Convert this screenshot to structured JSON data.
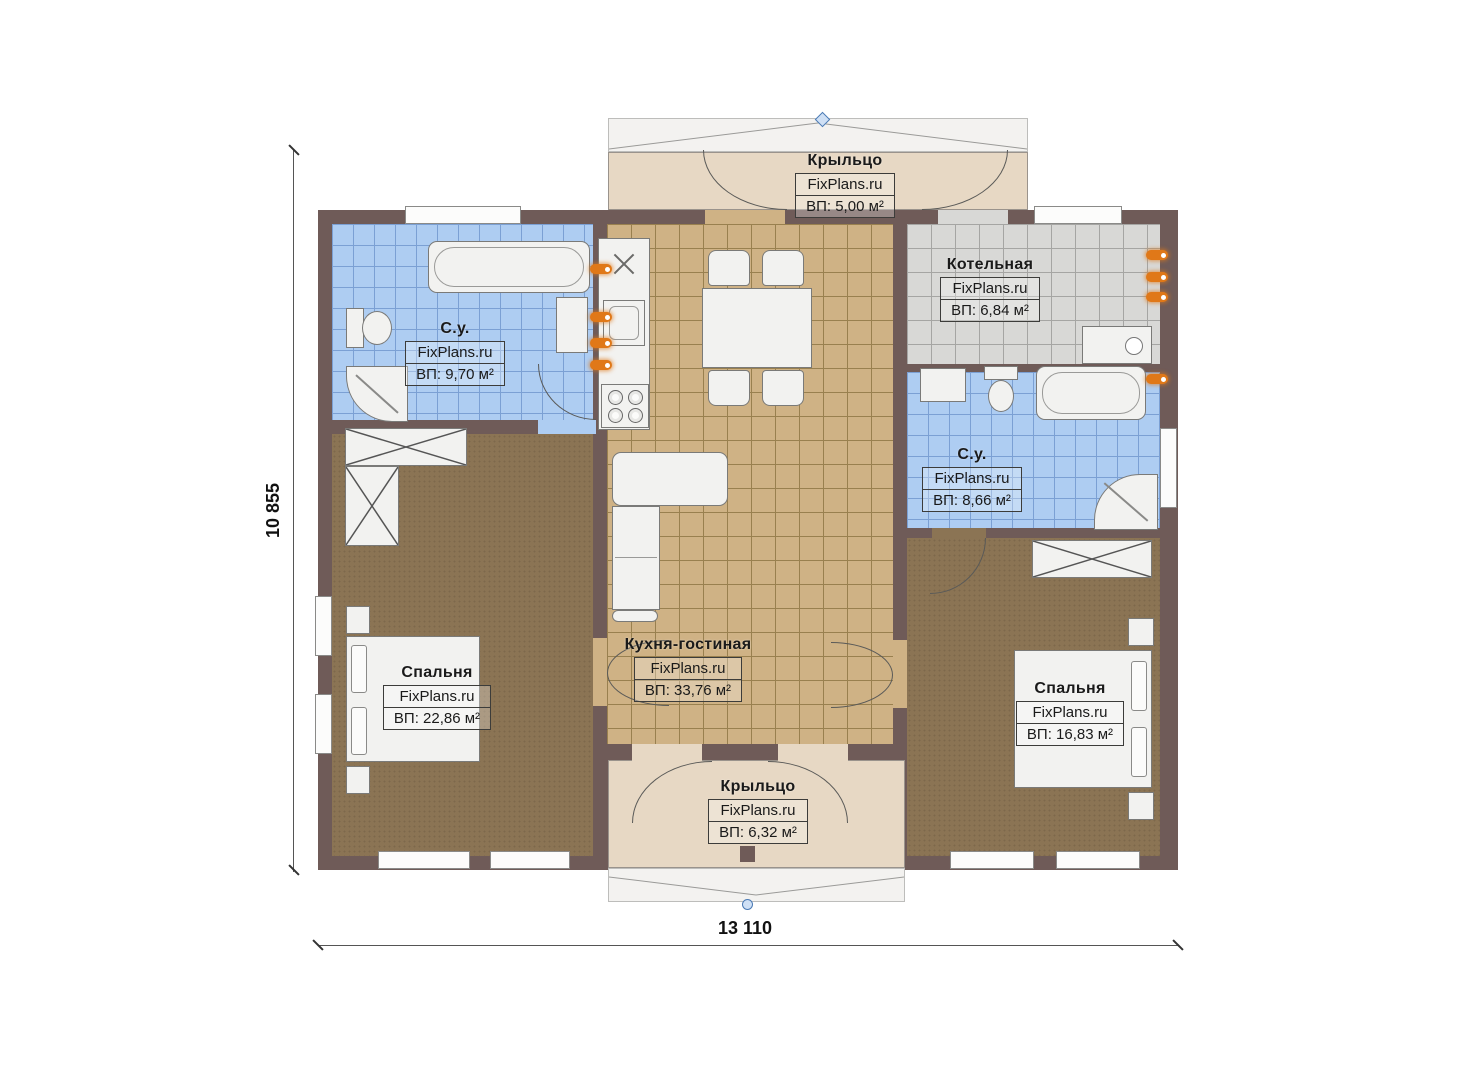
{
  "plan": {
    "title": "Floor plan",
    "watermark": "FixPlans.ru",
    "dimensions": {
      "width_label": "13 110",
      "height_label": "10 855"
    },
    "rooms": [
      {
        "id": "porch-top",
        "name": "Крыльцо",
        "watermark": "FixPlans.ru",
        "area": "ВП: 5,00 м²"
      },
      {
        "id": "boiler",
        "name": "Котельная",
        "watermark": "FixPlans.ru",
        "area": "ВП: 6,84 м²"
      },
      {
        "id": "bath-left",
        "name": "С.у.",
        "watermark": "FixPlans.ru",
        "area": "ВП: 9,70 м²"
      },
      {
        "id": "bath-right",
        "name": "С.у.",
        "watermark": "FixPlans.ru",
        "area": "ВП: 8,66 м²"
      },
      {
        "id": "bedroom-left",
        "name": "Спальня",
        "watermark": "FixPlans.ru",
        "area": "ВП: 22,86 м²"
      },
      {
        "id": "bedroom-right",
        "name": "Спальня",
        "watermark": "FixPlans.ru",
        "area": "ВП: 16,83 м²"
      },
      {
        "id": "kitchen-living",
        "name": "Кухня-гостиная",
        "watermark": "FixPlans.ru",
        "area": "ВП: 33,76 м²"
      },
      {
        "id": "porch-bottom",
        "name": "Крыльцо",
        "watermark": "FixPlans.ru",
        "area": "ВП: 6,32 м²"
      }
    ],
    "colors": {
      "wall": "#6f5b58",
      "bathroom_tile": "#aecdf2",
      "kitchen_tile": "#cfb285",
      "boiler_tile": "#d8d8d6",
      "bedroom_floor": "#8b7454",
      "porch_floor": "#e7d8c4",
      "fixture": "#f2f2f0",
      "radiator_orange": "#e07818",
      "marker_blue": "#4a7ab5"
    }
  }
}
